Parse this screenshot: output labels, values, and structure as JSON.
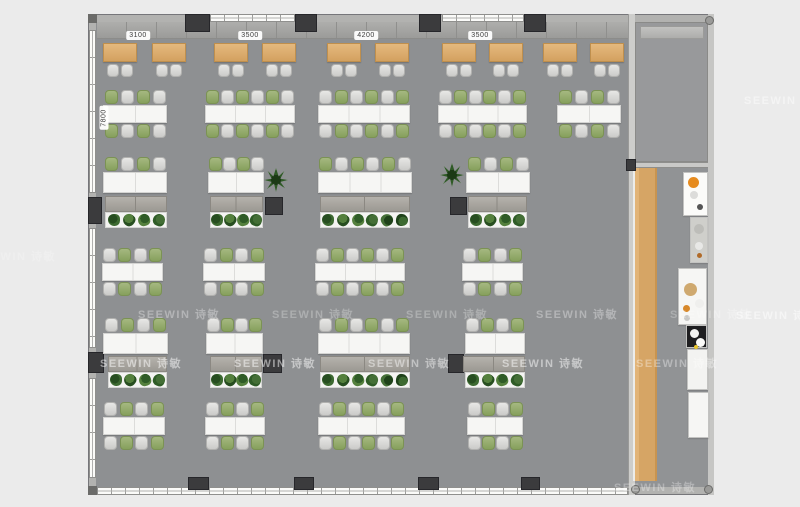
{
  "watermark": {
    "text": "SEEWIN 诗敏",
    "instances": [
      {
        "x": 138,
        "y": 306,
        "o": 0.33
      },
      {
        "x": 272,
        "y": 306,
        "o": 0.27
      },
      {
        "x": 406,
        "y": 306,
        "o": 0.27
      },
      {
        "x": 536,
        "y": 306,
        "o": 0.33
      },
      {
        "x": 670,
        "y": 306,
        "o": 0.25
      },
      {
        "x": 736,
        "y": 307,
        "o": 0.5
      },
      {
        "x": 100,
        "y": 355,
        "o": 0.5
      },
      {
        "x": 234,
        "y": 355,
        "o": 0.5
      },
      {
        "x": 368,
        "y": 355,
        "o": 0.45
      },
      {
        "x": 502,
        "y": 355,
        "o": 0.5
      },
      {
        "x": 636,
        "y": 355,
        "o": 0.35
      },
      {
        "x": 744,
        "y": 92,
        "o": 0.45
      },
      {
        "x": 614,
        "y": 479,
        "o": 0.3
      },
      {
        "x": -26,
        "y": 248,
        "o": 0.22
      }
    ]
  },
  "dimensions": {
    "top": [
      {
        "label": "3100",
        "cx": 138,
        "y": 31
      },
      {
        "label": "3500",
        "cx": 250,
        "y": 31
      },
      {
        "label": "4200",
        "cx": 366,
        "y": 31
      },
      {
        "label": "3500",
        "cx": 480,
        "y": 31
      }
    ],
    "left": [
      {
        "label": "7800",
        "cx": 104,
        "cy": 118
      }
    ]
  },
  "colors": {
    "background": "#ebebeb",
    "floor": "#8e9092",
    "meeting_room_floor": "#98999b",
    "wall": "#b2b2b0",
    "pillar": "#3b3b3d",
    "window": "#fbfbf9",
    "wood": "#d6a565",
    "desk": "#f6f6f4",
    "chair_green": "#86a05c",
    "chair_gray": "#d8d8d6",
    "lounge_table": "#d3a160",
    "accent_orange": "#e68b1e"
  },
  "arch": {
    "top_windows": [
      {
        "x": 210,
        "w": 85
      },
      {
        "x": 442,
        "w": 82
      }
    ],
    "left_windows": [
      {
        "y": 30,
        "h": 163
      },
      {
        "y": 228,
        "h": 120
      },
      {
        "y": 378,
        "h": 100
      }
    ],
    "bottom_window": {
      "x": 97,
      "y": 487,
      "w": 531,
      "h": 8
    },
    "top_pillars": [
      {
        "x": 185,
        "w": 25
      },
      {
        "x": 295,
        "w": 22
      },
      {
        "x": 419,
        "w": 22
      },
      {
        "x": 524,
        "w": 22
      }
    ],
    "bottom_pillars": [
      {
        "x": 188,
        "w": 21
      },
      {
        "x": 294,
        "w": 20
      },
      {
        "x": 418,
        "w": 21
      },
      {
        "x": 521,
        "w": 19
      }
    ],
    "mid_pillars": [
      {
        "x": 265,
        "y": 197,
        "w": 18,
        "h": 18
      },
      {
        "x": 450,
        "y": 197,
        "w": 17,
        "h": 18
      },
      {
        "x": 263,
        "y": 354,
        "w": 19,
        "h": 19
      },
      {
        "x": 448,
        "y": 354,
        "w": 16,
        "h": 19
      },
      {
        "x": 88,
        "y": 197,
        "w": 14,
        "h": 27
      },
      {
        "x": 88,
        "y": 352,
        "w": 16,
        "h": 21
      },
      {
        "x": 626,
        "y": 159,
        "w": 10,
        "h": 12
      }
    ],
    "corner_blocks": [
      {
        "x": 88,
        "y": 14,
        "w": 9,
        "h": 9
      },
      {
        "x": 88,
        "y": 486,
        "w": 9,
        "h": 9
      }
    ],
    "knobs": [
      {
        "x": 705,
        "y": 16
      },
      {
        "x": 704,
        "y": 485
      },
      {
        "x": 631,
        "y": 485
      }
    ]
  },
  "furniture": {
    "lounge_tables": {
      "y": 43,
      "w": 34,
      "h": 19,
      "xs": [
        103,
        152,
        214,
        262,
        327,
        375,
        442,
        489,
        543,
        590
      ]
    },
    "clusters": [
      {
        "x": 103,
        "y": 105,
        "w": 64,
        "seats": 4,
        "start": "green"
      },
      {
        "x": 205,
        "y": 105,
        "w": 90,
        "seats": 6,
        "start": "green"
      },
      {
        "x": 318,
        "y": 105,
        "w": 92,
        "seats": 6,
        "start": "gray"
      },
      {
        "x": 438,
        "y": 105,
        "w": 89,
        "seats": 6,
        "start": "gray"
      },
      {
        "x": 557,
        "y": 105,
        "w": 64,
        "seats": 4,
        "start": "green"
      },
      {
        "x": 102,
        "y": 263,
        "w": 61,
        "seats": 4,
        "start": "gray"
      },
      {
        "x": 203,
        "y": 263,
        "w": 62,
        "seats": 4,
        "start": "gray"
      },
      {
        "x": 315,
        "y": 263,
        "w": 90,
        "seats": 6,
        "start": "gray"
      },
      {
        "x": 462,
        "y": 263,
        "w": 61,
        "seats": 4,
        "start": "gray"
      },
      {
        "x": 103,
        "y": 417,
        "w": 62,
        "seats": 4,
        "start": "gray"
      },
      {
        "x": 205,
        "y": 417,
        "w": 60,
        "seats": 4,
        "start": "gray"
      },
      {
        "x": 318,
        "y": 417,
        "w": 87,
        "seats": 6,
        "start": "gray"
      },
      {
        "x": 467,
        "y": 417,
        "w": 56,
        "seats": 4,
        "start": "gray"
      }
    ],
    "desk_rows": [
      {
        "x": 103,
        "y": 172,
        "w": 64,
        "seats": 4,
        "start": "green"
      },
      {
        "x": 208,
        "y": 172,
        "w": 56,
        "seats": 4,
        "start": "green"
      },
      {
        "x": 318,
        "y": 172,
        "w": 94,
        "seats": 6,
        "start": "green"
      },
      {
        "x": 466,
        "y": 172,
        "w": 64,
        "seats": 4,
        "start": "green"
      },
      {
        "x": 103,
        "y": 333,
        "w": 65,
        "seats": 4,
        "start": "gray"
      },
      {
        "x": 206,
        "y": 333,
        "w": 57,
        "seats": 4,
        "start": "gray"
      },
      {
        "x": 318,
        "y": 333,
        "w": 92,
        "seats": 6,
        "start": "gray"
      },
      {
        "x": 465,
        "y": 333,
        "w": 60,
        "seats": 4,
        "start": "gray"
      }
    ],
    "cabinets": [
      {
        "x": 105,
        "y": 196,
        "w": 62
      },
      {
        "x": 210,
        "y": 196,
        "w": 53
      },
      {
        "x": 320,
        "y": 196,
        "w": 90
      },
      {
        "x": 468,
        "y": 196,
        "w": 59
      },
      {
        "x": 108,
        "y": 356,
        "w": 59
      },
      {
        "x": 210,
        "y": 356,
        "w": 52
      },
      {
        "x": 320,
        "y": 356,
        "w": 90
      },
      {
        "x": 463,
        "y": 356,
        "w": 62
      }
    ],
    "planters": [
      {
        "x": 105,
        "y": 212,
        "w": 62,
        "n": 4
      },
      {
        "x": 210,
        "y": 212,
        "w": 53,
        "n": 4
      },
      {
        "x": 320,
        "y": 212,
        "w": 90,
        "n": 6
      },
      {
        "x": 468,
        "y": 212,
        "w": 59,
        "n": 4
      },
      {
        "x": 108,
        "y": 372,
        "w": 59,
        "n": 4
      },
      {
        "x": 210,
        "y": 372,
        "w": 52,
        "n": 4
      },
      {
        "x": 320,
        "y": 372,
        "w": 90,
        "n": 6
      },
      {
        "x": 465,
        "y": 372,
        "w": 60,
        "n": 4
      }
    ],
    "plants": [
      {
        "x": 264,
        "y": 168
      },
      {
        "x": 440,
        "y": 163
      }
    ],
    "kitchen_units": [
      {
        "x": 683,
        "y": 172,
        "w": 25,
        "h": 44,
        "bg": "#fbfbf9",
        "dots": [
          {
            "dx": 4,
            "dy": 4,
            "r": 11,
            "c": "#e68b1e"
          },
          {
            "dx": 6,
            "dy": 18,
            "r": 8,
            "c": "#dcdcda"
          },
          {
            "dx": 13,
            "dy": 31,
            "r": 6,
            "c": "#555555"
          }
        ]
      },
      {
        "x": 690,
        "y": 217,
        "w": 18,
        "h": 46,
        "bg": "#cfcfcb",
        "dots": [
          {
            "dx": 3,
            "dy": 6,
            "r": 10,
            "c": "#bdbdb9"
          },
          {
            "dx": 4,
            "dy": 24,
            "r": 8,
            "c": "#e8e8e6"
          },
          {
            "dx": 6,
            "dy": 35,
            "r": 5,
            "c": "#b06a28"
          }
        ]
      },
      {
        "x": 678,
        "y": 268,
        "w": 29,
        "h": 57,
        "bg": "#f6f6f4",
        "dots": [
          {
            "dx": 5,
            "dy": 14,
            "r": 13,
            "c": "#cfa96f"
          },
          {
            "dx": 16,
            "dy": 30,
            "r": 9,
            "c": "#efefed"
          },
          {
            "dx": 4,
            "dy": 36,
            "r": 7,
            "c": "#d7882a"
          },
          {
            "dx": 5,
            "dy": 46,
            "r": 6,
            "c": "#c9c9c7"
          }
        ]
      },
      {
        "x": 686,
        "y": 325,
        "w": 21,
        "h": 23,
        "bg": "#1e1e20",
        "dots": [
          {
            "dx": 3,
            "dy": 3,
            "r": 9,
            "c": "#f2f2f0"
          },
          {
            "dx": 9,
            "dy": 12,
            "r": 9,
            "c": "#fafaf8"
          },
          {
            "dx": 7,
            "dy": 19,
            "r": 4,
            "c": "#e8c52c"
          }
        ]
      },
      {
        "x": 687,
        "y": 349,
        "w": 21,
        "h": 41,
        "bg": "#f3f3f1",
        "dots": []
      },
      {
        "x": 688,
        "y": 392,
        "w": 21,
        "h": 46,
        "bg": "#f6f6f4",
        "dots": []
      }
    ]
  }
}
